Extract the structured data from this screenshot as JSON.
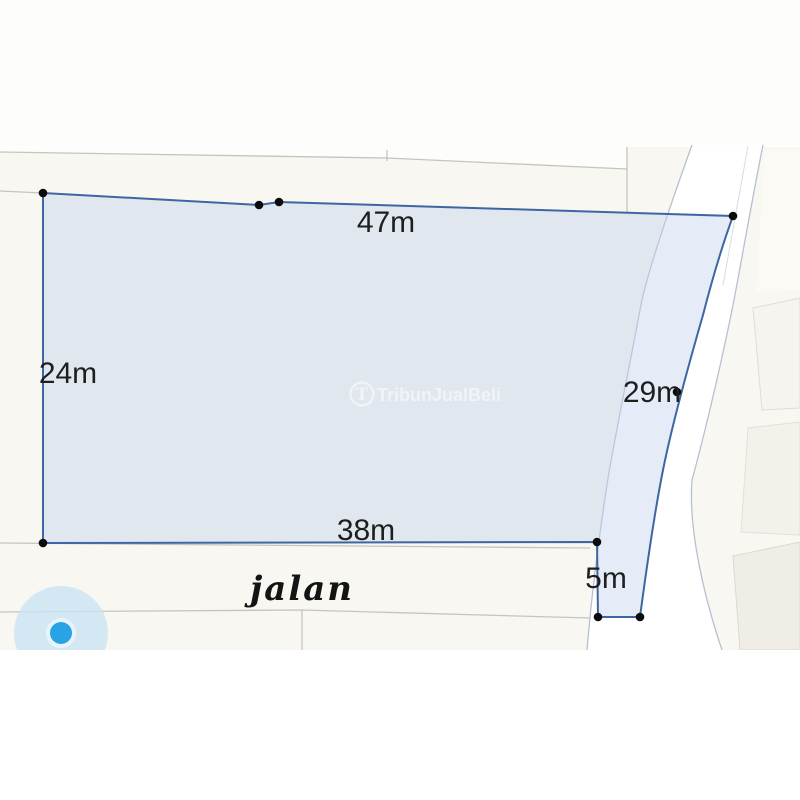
{
  "watermark": {
    "text": "TribunJualBeli",
    "logo_letter": "T",
    "color": "#ffffff",
    "opacity": "0.5"
  },
  "map": {
    "road_label": "jalan",
    "base_color": "#f8f7f1",
    "upper_parcel_color": "#fdfdfb",
    "road_fill": "#ffffff",
    "parcel_line_color": "#c7c4bd",
    "road_edge_color": "#b8bfd3",
    "marker": {
      "outer_color": "#cbe3f5",
      "ring_color": "#e8f4fb",
      "dot_color": "#29a3e3",
      "cx": "61",
      "cy": "633",
      "outer_r": "47",
      "ring_r": "15",
      "dot_r": "11"
    }
  },
  "plot": {
    "fill": "rgba(193,209,235,0.42)",
    "stroke": "#3e66a2",
    "outline_path": "M43,193 L259,205 L279,202 L733,216 C722,246 712,280 703,315 C690,360 673,420 663,470 C655,510 646,572 640,617 L598,617 L597,542 L43,543 Z",
    "dot_color": "#0b0b0b",
    "dot_r": "4.3",
    "dots": [
      {
        "x": "43",
        "y": "193"
      },
      {
        "x": "259",
        "y": "205"
      },
      {
        "x": "279",
        "y": "202"
      },
      {
        "x": "733",
        "y": "216"
      },
      {
        "x": "677",
        "y": "392"
      },
      {
        "x": "640",
        "y": "617"
      },
      {
        "x": "598",
        "y": "617"
      },
      {
        "x": "597",
        "y": "542"
      },
      {
        "x": "43",
        "y": "543"
      }
    ],
    "measurements": [
      {
        "label": "47m",
        "x": "386",
        "y": "232"
      },
      {
        "label": "24m",
        "x": "68",
        "y": "383"
      },
      {
        "label": "29m",
        "x": "652",
        "y": "402"
      },
      {
        "label": "38m",
        "x": "366",
        "y": "540"
      },
      {
        "label": "5m",
        "x": "606",
        "y": "588"
      }
    ],
    "road_label_x": "302",
    "road_label_y": "600"
  }
}
